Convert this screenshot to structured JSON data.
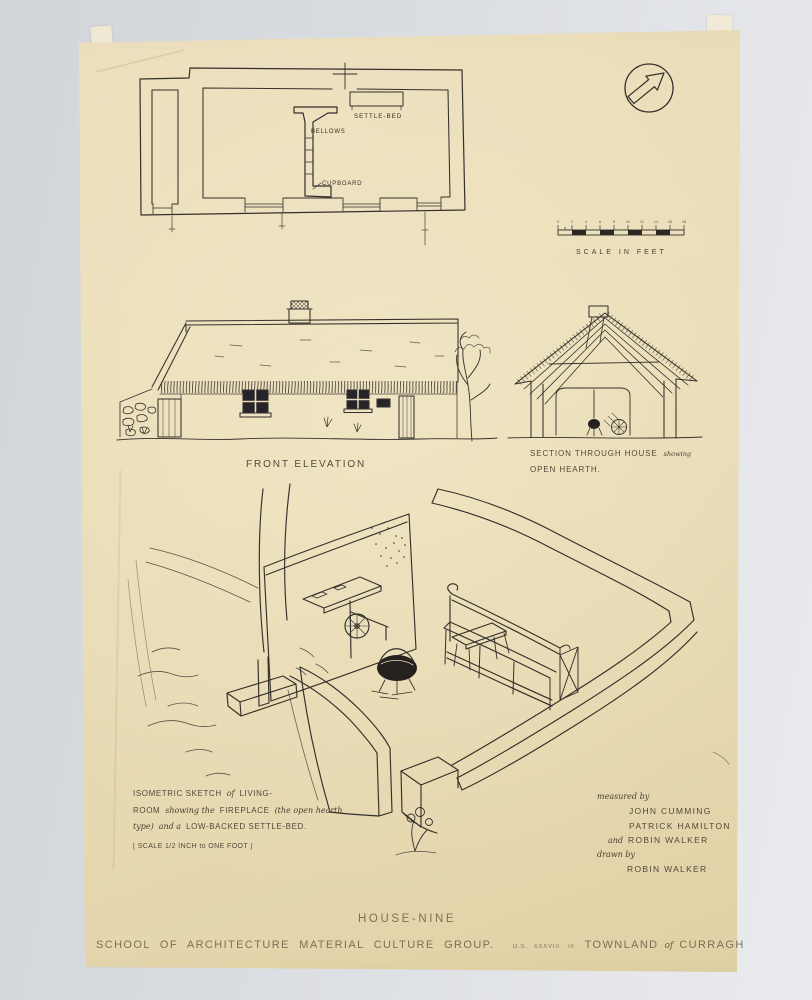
{
  "sheet": {
    "title": "HOUSE-NINE",
    "org_line": "SCHOOL OF ARCHITECTURE MATERIAL CULTURE GROUP.",
    "os_ref": "O.S.",
    "os_sheet": "XXXVIII",
    "os_sub": "in",
    "townland_a": "TOWNLAND",
    "townland_of": "of",
    "townland_b": "CURRAGH"
  },
  "plan": {
    "settle_bed_label": "SETTLE-BED",
    "bellows_label": "BELLOWS",
    "cupboard_label": "CUPBOARD"
  },
  "scale_bar": {
    "caption": "SCALE IN FEET",
    "tick_labels": [
      "0",
      "2",
      "4",
      "6",
      "8",
      "10",
      "12",
      "14",
      "16",
      "18"
    ]
  },
  "elevation": {
    "caption": "FRONT ELEVATION"
  },
  "section": {
    "caption_main": "SECTION THROUGH HOUSE",
    "caption_script": "showing",
    "caption_line2": "OPEN HEARTH."
  },
  "iso_note": {
    "l1_caps1": "ISOMETRIC SKETCH",
    "l1_script": "of",
    "l1_caps2": "LIVING-",
    "l2_caps1": "ROOM",
    "l2_script1": "showing the",
    "l2_caps2": "FIREPLACE",
    "l2_script2": "(the open hearth",
    "l3_script1": "type)",
    "l3_script2": "and a",
    "l3_caps": "LOW-BACKED SETTLE-BED.",
    "l4": "[ SCALE  1/2 INCH to ONE FOOT ]"
  },
  "credits": {
    "measured_by": "measured by",
    "name1": "JOHN CUMMING",
    "name2": "PATRICK HAMILTON",
    "and_word": "and",
    "name3": "ROBIN WALKER",
    "drawn_by": "drawn by",
    "name4": "ROBIN WALKER"
  },
  "icons": {
    "north_arrow": "north-arrow"
  },
  "colors": {
    "background": "#d9dce1",
    "paper": "#e9dcb8",
    "ink": "#34302b",
    "pencil": "#6d5d45"
  }
}
